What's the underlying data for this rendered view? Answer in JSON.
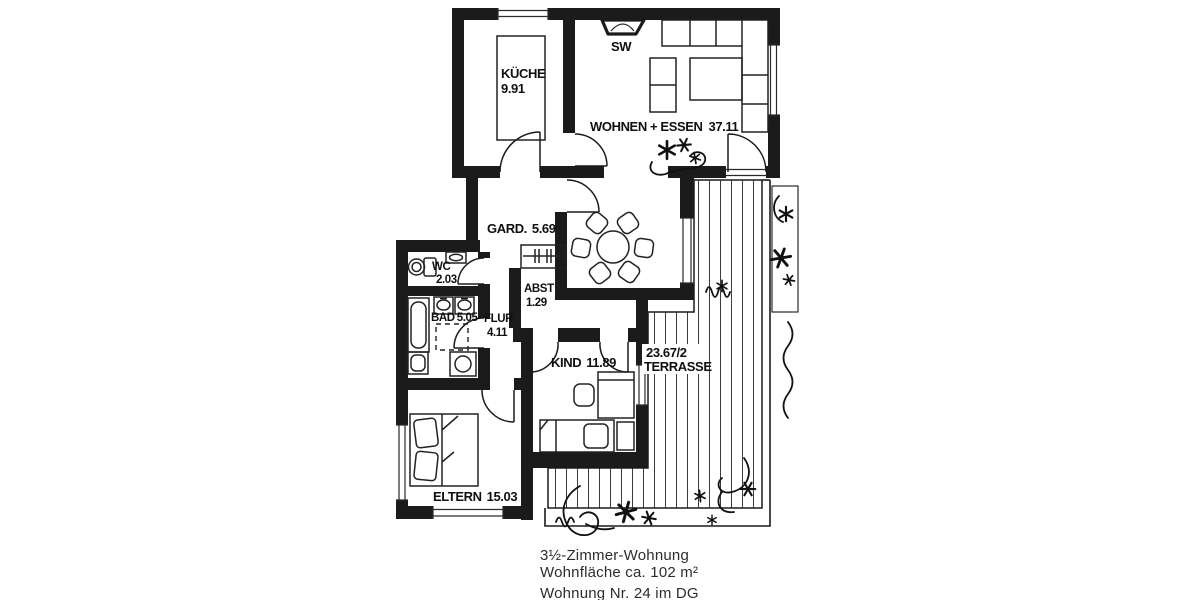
{
  "floorplan": {
    "rooms": {
      "kueche": {
        "name": "KÜCHE",
        "area": "9.91"
      },
      "wohnen_essen": {
        "name": "WOHNEN + ESSEN",
        "area": "37.11"
      },
      "garderobe": {
        "name": "GARD.",
        "area": "5.69"
      },
      "abstellraum": {
        "name": "ABST",
        "area": "1.29"
      },
      "wc": {
        "name": "WC",
        "area": "2.03"
      },
      "bad": {
        "name": "BAD",
        "area": "5.05"
      },
      "flur": {
        "name": "FLUR",
        "area": "4.11"
      },
      "kind": {
        "name": "KIND",
        "area": "11.89"
      },
      "eltern": {
        "name": "ELTERN",
        "area": "15.03"
      },
      "terrasse": {
        "name": "TERRASSE",
        "area": "23.67/2"
      }
    },
    "annotations": {
      "shaft_label": "SW"
    },
    "caption": {
      "line1": "3½-Zimmer-Wohnung",
      "line2": "Wohnfläche ca. 102 m²",
      "line3": "Wohnung Nr. 24 im DG"
    },
    "icons": {
      "plant": "asterisk-star",
      "door": "quarter-arc"
    },
    "colors": {
      "ink": "#1b1b1b",
      "paper": "#ffffff",
      "caption_text": "#2d2d2d"
    }
  }
}
